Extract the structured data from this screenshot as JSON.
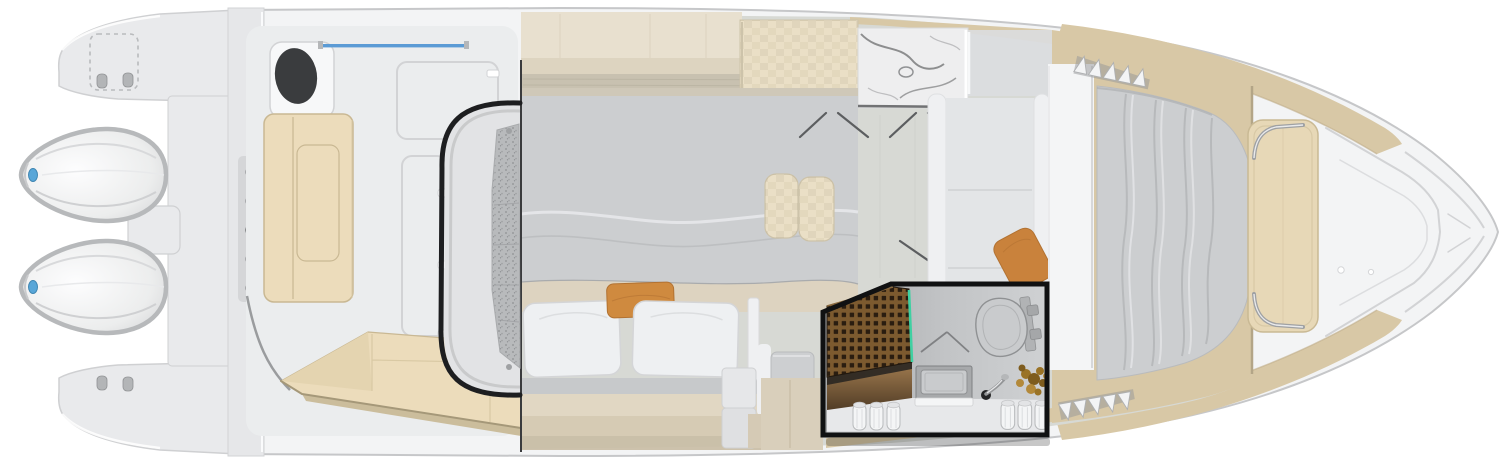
{
  "page": {
    "title": "Yacht deck and cabin floor plan — top view",
    "background": "#ffffff"
  },
  "colors": {
    "hull": "#f3f4f5",
    "hullLine": "#c6c7c9",
    "deck": "#ebedee",
    "platform": "#e9eaec",
    "platformLine": "#cfd0d2",
    "seam": "#d2d3d5",
    "cut": "#3a3b3d",
    "black": "#121314",
    "engine": "#f6f7f8",
    "engineRim": "#b7b9bb",
    "engineBlue": "#58a6d8",
    "tanCushion": "#ecdcbb",
    "tanCushionEdge": "#c9b893",
    "gunwale": "#d8c8a6",
    "gunwaleDark": "#bfae8a",
    "cab": "#e8e0cf",
    "cabDark": "#ddd4c0",
    "woodStrip": "#c8c1b0",
    "wood": "#eadfc6",
    "woodEdge": "#cdc3aa",
    "marble": "#eeeeef",
    "vein": "#7b7c7e",
    "floor": "#d7d9d4",
    "floorLine": "#c6c8c2",
    "bed": "#ccced0",
    "bedBase": "#ddd3c0",
    "pillow": "#eef0f2",
    "pillowLine": "#d4d5d7",
    "orange": "#cf8a3f",
    "orangeDark": "#b27232",
    "settee": "#eff0f2",
    "seat": "#e3e5e7",
    "teak": "#7c5a2f",
    "teakHole": "#2a1d10",
    "teal": "#3fd0a2",
    "towel": "#f4f5f6",
    "towelLine": "#b9bbbd",
    "plant1": "#9a7326",
    "plant2": "#7e5c1e",
    "plant3": "#b3893a",
    "blue": "#5b9bd5",
    "chrome": "#9fa1a3"
  },
  "plan": {
    "boat": {
      "name": "Boat floor plan — overhead cutaway view"
    },
    "stern": {
      "name": "Transom, swim platform and twin outboard engines",
      "engine_count": 2
    },
    "cockpit": {
      "name": "Cockpit with L-bench, grill hatch, deck hatches and aft sun pad"
    },
    "companionway": {
      "name": "Companionway steps down to cabin"
    },
    "galley": {
      "name": "Galley with wood and marble countertops"
    },
    "mid_cabin": {
      "name": "Mid-cabin berth",
      "white_pillows": 2,
      "orange_pillows": 1
    },
    "dinette": {
      "name": "Salon / dinette with twin stools and settee"
    },
    "head": {
      "name": "Head (bathroom) — highlighted compartment",
      "highlighted": true,
      "fixtures": [
        "teak shower grate",
        "vanity sink",
        "faucet",
        "toilet",
        "towel rolls",
        "plant"
      ],
      "towel_rolls_left": 3,
      "towel_rolls_right": 3
    },
    "bow_cabin": {
      "name": "Forward berth with duvet and access steps"
    },
    "bow_deck": {
      "name": "Bow deck with sun pad, grab rails and anchor locker"
    }
  }
}
